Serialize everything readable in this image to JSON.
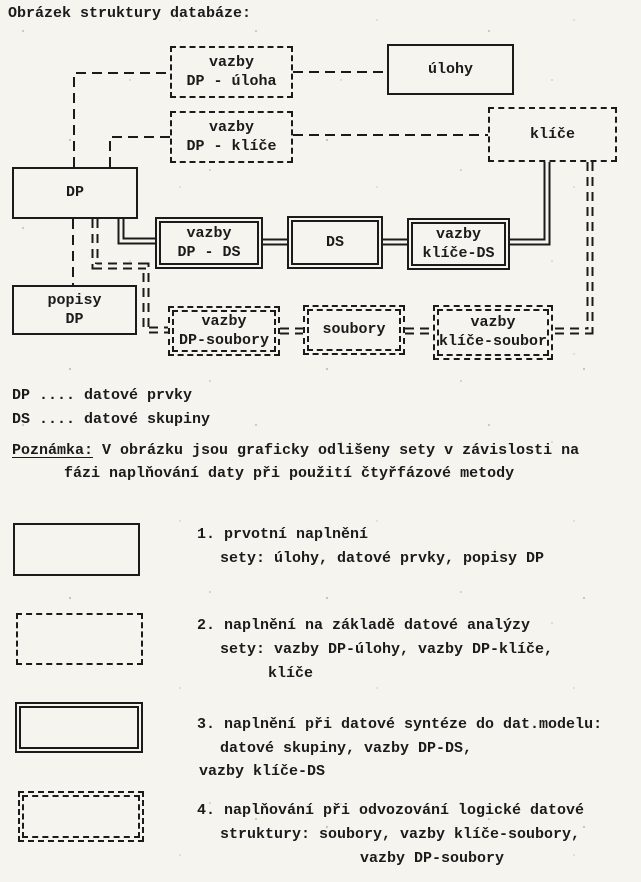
{
  "page": {
    "title": "Obrázek struktury databáze:"
  },
  "colors": {
    "ink": "#1b1b1b",
    "paper": "#f6f4ee"
  },
  "diagram": {
    "boxes": [
      {
        "id": "vazby-dp-uloha",
        "lines": [
          "vazby",
          "DP - úloha"
        ],
        "style": "dashed",
        "phase": 2
      },
      {
        "id": "ulohy",
        "lines": [
          "úlohy"
        ],
        "style": "solid",
        "phase": 1
      },
      {
        "id": "vazby-dp-klice",
        "lines": [
          "vazby",
          "DP - klíče"
        ],
        "style": "dashed",
        "phase": 2
      },
      {
        "id": "klice",
        "lines": [
          "klíče"
        ],
        "style": "dashed",
        "phase": 2
      },
      {
        "id": "dp",
        "lines": [
          "DP"
        ],
        "style": "solid",
        "phase": 1
      },
      {
        "id": "vazby-dp-ds",
        "lines": [
          "vazby",
          "DP - DS"
        ],
        "style": "double-solid",
        "phase": 3
      },
      {
        "id": "ds",
        "lines": [
          "DS"
        ],
        "style": "double-solid",
        "phase": 3
      },
      {
        "id": "vazby-klice-ds",
        "lines": [
          "vazby",
          "klíče-DS"
        ],
        "style": "double-solid",
        "phase": 3
      },
      {
        "id": "popisy-dp",
        "lines": [
          "popisy",
          "DP"
        ],
        "style": "solid",
        "phase": 1
      },
      {
        "id": "vazby-dp-soubory",
        "lines": [
          "vazby",
          "DP-soubory"
        ],
        "style": "double-dashed",
        "phase": 4
      },
      {
        "id": "soubory",
        "lines": [
          "soubory"
        ],
        "style": "double-dashed",
        "phase": 4
      },
      {
        "id": "vazby-klice-soubor",
        "lines": [
          "vazby",
          "klíče-soubor"
        ],
        "style": "double-dashed",
        "phase": 4
      }
    ],
    "connections": {
      "dashed": [
        "M74 167 V73 H170",
        "M293 72 H387",
        "M110 167 V137 H170",
        "M293 135 H488",
        "M73 219 V285"
      ],
      "double_solid": [
        "M121 219 V241 H155",
        "M263 242 H287",
        "M383 242 H407",
        "M510 242 H547 V162"
      ],
      "double_dashed": [
        "M95 219 V266 H146 V330 H168",
        "M280 331 H303",
        "M405 331 H433",
        "M590 162 V331 H553"
      ]
    }
  },
  "abbreviations": [
    {
      "term": "DP",
      "definition": "datové prvky",
      "text": "DP .... datové prvky"
    },
    {
      "term": "DS",
      "definition": "datové skupiny",
      "text": "DS .... datové skupiny"
    }
  ],
  "note": {
    "label": "Poznámka:",
    "line1": "V obrázku jsou graficky odlišeny sety v závislosti na",
    "line2": "fázi naplňování daty při použití čtyřfázové metody"
  },
  "legend": [
    {
      "swatch": "solid",
      "phase": 1,
      "lines": [
        "1. prvotní naplnění",
        "sety: úlohy, datové prvky, popisy DP"
      ]
    },
    {
      "swatch": "dashed",
      "phase": 2,
      "lines": [
        "2. naplnění na základě datové analýzy",
        "sety: vazby DP-úlohy, vazby DP-klíče,",
        "klíče"
      ]
    },
    {
      "swatch": "double-solid",
      "phase": 3,
      "lines": [
        "3. naplnění při datové syntéze do dat.modelu:",
        "datové skupiny, vazby DP-DS,",
        "vazby klíče-DS"
      ]
    },
    {
      "swatch": "double-dashed",
      "phase": 4,
      "lines": [
        "4. naplňování při odvozování logické datové",
        "struktury: soubory, vazby klíče-soubory,",
        "vazby DP-soubory"
      ]
    }
  ]
}
